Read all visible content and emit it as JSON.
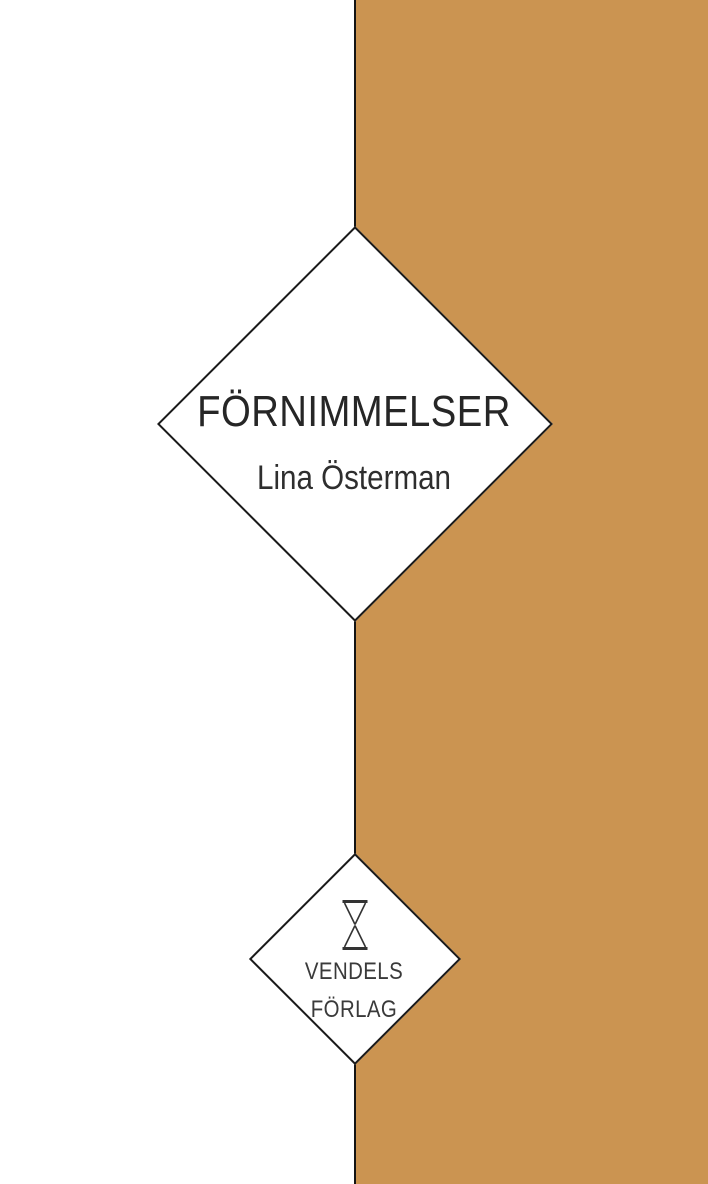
{
  "cover": {
    "title": "FÖRNIMMELSER",
    "author": "Lina Österman",
    "publisher": {
      "line1": "VENDELS",
      "line2": "FÖRLAG"
    },
    "logo_icon": "hourglass-icon",
    "colors": {
      "background": "#FFFFFF",
      "accent": "#CB9451",
      "divider": "#141414",
      "diamond_border": "#1A1A1A",
      "title_text": "#262626",
      "author_text": "#2E2E2E",
      "publisher_text": "#3A3A3A",
      "logo_stroke": "#333333"
    }
  }
}
